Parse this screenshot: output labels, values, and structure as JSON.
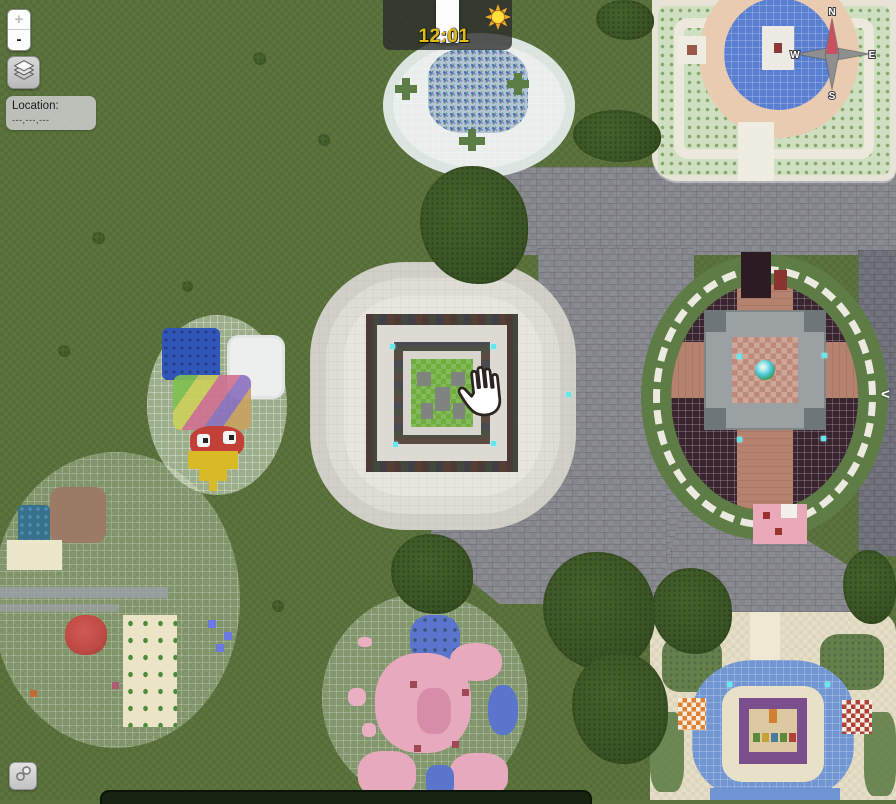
{
  "ui": {
    "zoom": {
      "in_label": "+",
      "out_label": "-"
    },
    "location": {
      "label": "Location:",
      "value": "---,---,---"
    },
    "clock": {
      "time": "12:01"
    },
    "compass": {
      "n": "N",
      "e": "E",
      "s": "S",
      "w": "W"
    },
    "panel_toggle_label": "<"
  },
  "icons": {
    "layers": "layers-icon",
    "link": "link-icon",
    "sun": "sun-icon",
    "hand": "grab-hand-cursor-icon"
  },
  "colors": {
    "grass": "#5b733d",
    "stone_path": "#85858c",
    "tree": "#3a5424",
    "clock_text": "#e2bd16",
    "clock_bg": "rgba(42,42,42,0.78)",
    "compass_north_needle": "#c85060",
    "snow_build": "#e9eeec",
    "center_build": "#e7e5de",
    "water_blue": "#5b7fd0",
    "flower_pink": "#e7a9be",
    "rose_circle_dark": "#3a2430"
  },
  "map": {
    "structures": [
      {
        "name": "snow-village-circle"
      },
      {
        "name": "northeast-garden-plaza"
      },
      {
        "name": "east-rose-circle"
      },
      {
        "name": "center-spiral-keep"
      },
      {
        "name": "west-parrot-pixel-art"
      },
      {
        "name": "southwest-garden-circle"
      },
      {
        "name": "south-flower-circle"
      },
      {
        "name": "southeast-temple-plaza"
      }
    ]
  }
}
